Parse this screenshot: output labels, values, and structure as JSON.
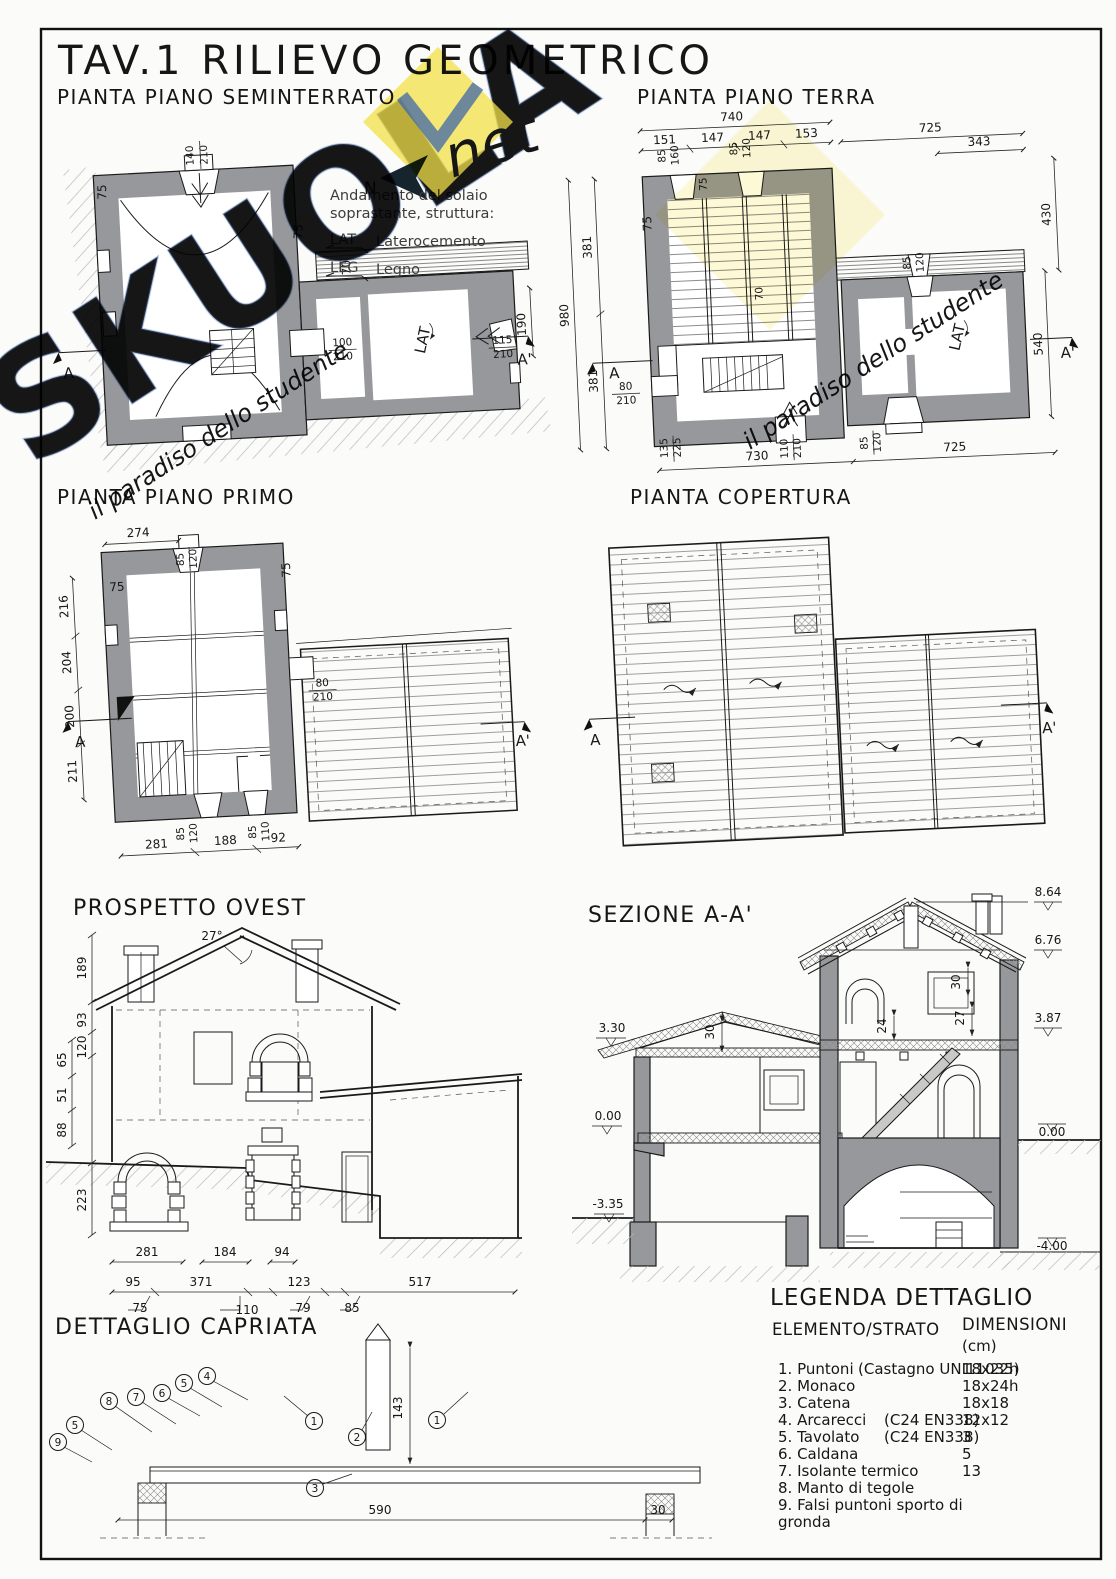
{
  "sheet": {
    "title": "TAV.1  RILIEVO  GEOMETRICO"
  },
  "watermark": {
    "word": "SKUOLA",
    "script": "net",
    "tagline": "il paradiso dello studente"
  },
  "north": {
    "label": "N"
  },
  "note": {
    "line1": "Andamento del solaio",
    "line2": "soprastante, struttura:",
    "lat_abbr": "LAT",
    "lat_label": "Laterocemento",
    "leg_abbr": "LEG",
    "leg_label": "Legno"
  },
  "sem": {
    "title": "PIANTA PIANO SEMINTERRATO",
    "d140": "140",
    "d210a": "210",
    "w75l": "75",
    "w75r": "75",
    "w70": "70",
    "d190": "190",
    "d100": "100",
    "d210b": "210",
    "d115": "115",
    "d210c": "210",
    "lat": "LAT",
    "a": "A",
    "a1": "A'"
  },
  "terra": {
    "title": "PIANTA PIANO TERRA",
    "d740": "740",
    "d151": "151",
    "d147a": "147",
    "d147b": "147",
    "d153": "153",
    "d725t": "725",
    "d343": "343",
    "d980": "980",
    "d381a": "381",
    "d381b": "381",
    "w75": "75",
    "d80": "80",
    "d80h": "210",
    "d135": "135",
    "d135h": "225",
    "d430": "430",
    "d540": "540",
    "d730": "730",
    "d725b": "725",
    "d110": "110",
    "d110h": "210",
    "d85b": "85",
    "d85bh": "120",
    "d85t": "85",
    "d85th": "160",
    "d85t2": "85",
    "d85t2h": "120",
    "w75t": "75",
    "w70": "70",
    "d85r": "85",
    "d85rh": "120",
    "lat": "LAT",
    "a": "A",
    "a1": "A'"
  },
  "primo": {
    "title": "PIANTA PIANO PRIMO",
    "d274": "274",
    "d85t": "85",
    "d85th": "120",
    "w75l": "75",
    "w75r": "75",
    "d216": "216",
    "d204": "204",
    "d200": "200",
    "d211": "211",
    "d80": "80",
    "d80h": "210",
    "d281": "281",
    "d188": "188",
    "d92": "92",
    "d85b": "85",
    "d85bh": "120",
    "d85b2": "85",
    "d85b2h": "110",
    "a": "A",
    "a1": "A'"
  },
  "cop": {
    "title": "PIANTA COPERTURA",
    "a": "A",
    "a1": "A'"
  },
  "pro": {
    "title": "PROSPETTO OVEST",
    "ang": "27°",
    "d189": "189",
    "d93": "93",
    "d120": "120",
    "d65": "65",
    "d51": "51",
    "d88": "88",
    "d223": "223"
  },
  "sez": {
    "title": "SEZIONE A-A'",
    "l864": "8.64",
    "l676": "6.76",
    "l387": "3.87",
    "l330": "3.30",
    "l000a": "0.00",
    "l000b": "0.00",
    "l335": "-3.35",
    "l400": "-4.00",
    "d30a": "30",
    "d30b": "30",
    "d24": "24",
    "d27": "27"
  },
  "cap": {
    "title": "DETTAGLIO CAPRIATA",
    "d281": "281",
    "d184": "184",
    "d94": "94",
    "d95": "95",
    "d371": "371",
    "d123": "123",
    "d517": "517",
    "d75": "75",
    "d110": "110",
    "d79": "79",
    "d85": "85",
    "d143": "143",
    "d590": "590",
    "d30": "30",
    "c1": "1",
    "c2": "2",
    "c3": "3",
    "c4": "4",
    "c5": "5",
    "c6": "6",
    "c7": "7",
    "c8": "8",
    "c9": "9"
  },
  "leg": {
    "title": "LEGENDA DETTAGLIO",
    "col1": "ELEMENTO/STRATO",
    "col2": "DIMENSIONI",
    "col2b": "(cm)",
    "rows": [
      {
        "l": "1. Puntoni",
        "n": "(Castagno UNI11035)",
        "d": "18x22h"
      },
      {
        "l": "2. Monaco",
        "n": "",
        "d": "18x24h"
      },
      {
        "l": "3. Catena",
        "n": "",
        "d": "18x18"
      },
      {
        "l": "4. Arcarecci",
        "n": "(C24 EN338)",
        "d": "12x12"
      },
      {
        "l": "5. Tavolato",
        "n": "(C24 EN338)",
        "d": "3"
      },
      {
        "l": "6. Caldana",
        "n": "",
        "d": "5"
      },
      {
        "l": "7. Isolante termico",
        "n": "",
        "d": "13"
      },
      {
        "l": "8. Manto di tegole",
        "n": "",
        "d": ""
      },
      {
        "l": "9. Falsi puntoni sporto di",
        "n": "",
        "d": ""
      }
    ],
    "row9b": "gronda"
  }
}
